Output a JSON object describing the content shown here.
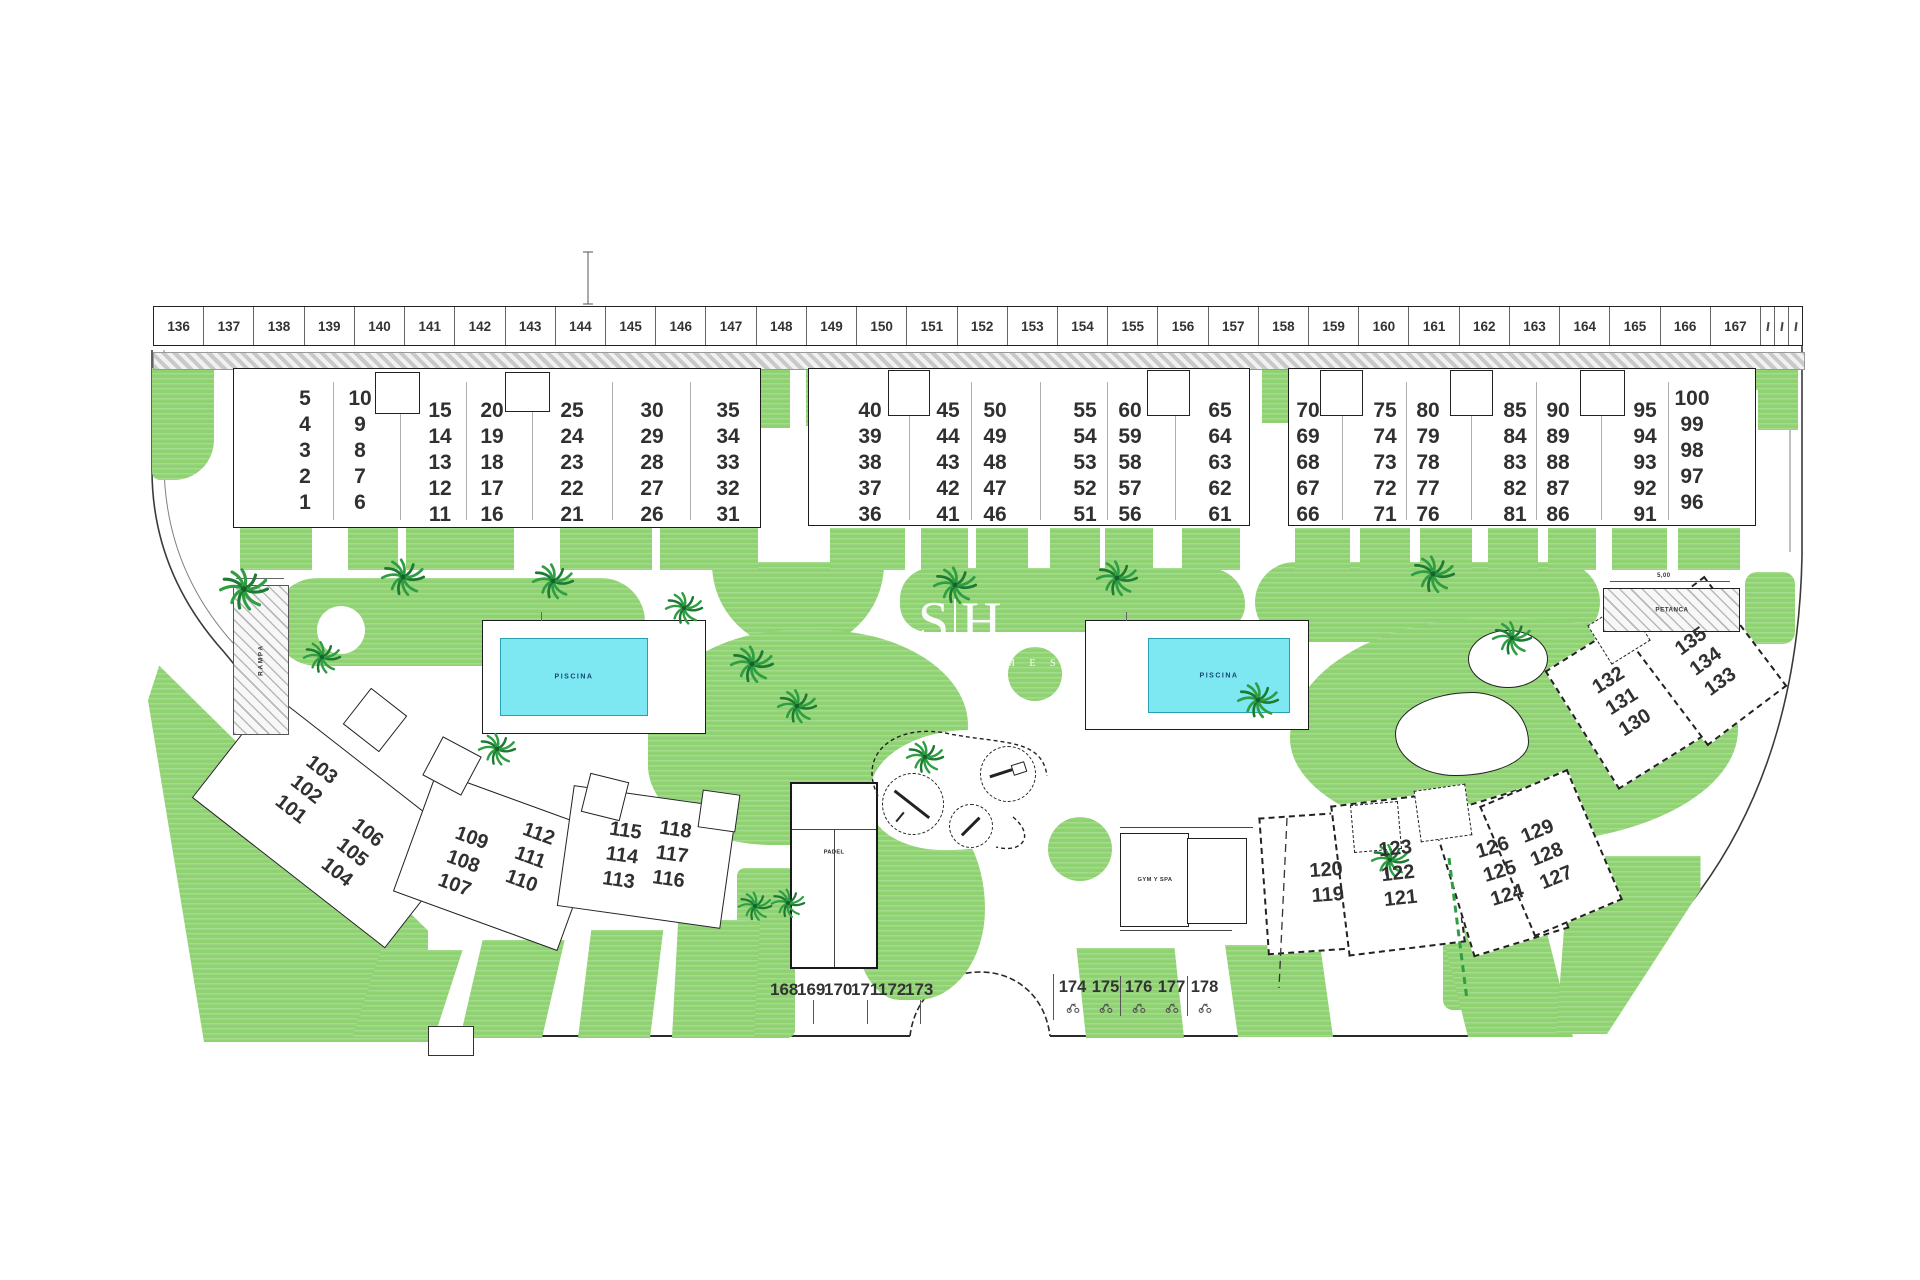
{
  "plan": {
    "watermark": {
      "left": "S",
      "right": "H",
      "sub": "M E S"
    },
    "parking": {
      "top_row": [
        "136",
        "137",
        "138",
        "139",
        "140",
        "141",
        "142",
        "143",
        "144",
        "145",
        "146",
        "147",
        "148",
        "149",
        "150",
        "151",
        "152",
        "153",
        "154",
        "155",
        "156",
        "157",
        "158",
        "159",
        "160",
        "161",
        "162",
        "163",
        "164",
        "165",
        "166",
        "167"
      ],
      "bottom_left_row": [
        "168",
        "169",
        "170",
        "171",
        "172",
        "173"
      ],
      "bottom_right_row": [
        "174",
        "175",
        "176",
        "177",
        "178"
      ]
    },
    "amenities": {
      "pool1_label": "PISCINA",
      "pool2_label": "PISCINA",
      "padel_label": "PADEL",
      "gym_label": "GYM Y SPA",
      "petanca_label": "PETANCA",
      "petanca_dim": "5,00",
      "ramp_label": "RAMPA"
    },
    "buildings": {
      "top": [
        {
          "name": "block-1",
          "columns": [
            [
              "5",
              "4",
              "3",
              "2",
              "1"
            ],
            [
              "10",
              "9",
              "8",
              "7",
              "6"
            ],
            [
              "15",
              "14",
              "13",
              "12",
              "11"
            ],
            [
              "20",
              "19",
              "18",
              "17",
              "16"
            ],
            [
              "25",
              "24",
              "23",
              "22",
              "21"
            ],
            [
              "30",
              "29",
              "28",
              "27",
              "26"
            ],
            [
              "35",
              "34",
              "33",
              "32",
              "31"
            ]
          ]
        },
        {
          "name": "block-2",
          "columns": [
            [
              "40",
              "39",
              "38",
              "37",
              "36"
            ],
            [
              "45",
              "44",
              "43",
              "42",
              "41"
            ],
            [
              "50",
              "49",
              "48",
              "47",
              "46"
            ],
            [
              "55",
              "54",
              "53",
              "52",
              "51"
            ],
            [
              "60",
              "59",
              "58",
              "57",
              "56"
            ],
            [
              "65",
              "64",
              "63",
              "62",
              "61"
            ]
          ]
        },
        {
          "name": "block-3",
          "columns": [
            [
              "70",
              "69",
              "68",
              "67",
              "66"
            ],
            [
              "75",
              "74",
              "73",
              "72",
              "71"
            ],
            [
              "80",
              "79",
              "78",
              "77",
              "76"
            ],
            [
              "85",
              "84",
              "83",
              "82",
              "81"
            ],
            [
              "90",
              "89",
              "88",
              "87",
              "86"
            ],
            [
              "95",
              "94",
              "93",
              "92",
              "91"
            ],
            [
              "100",
              "99",
              "98",
              "97",
              "96"
            ]
          ]
        }
      ],
      "bottom": [
        {
          "lines": [
            "103",
            "102",
            "101"
          ]
        },
        {
          "lines": [
            "106",
            "105",
            "104"
          ]
        },
        {
          "lines": [
            "109",
            "108",
            "107"
          ]
        },
        {
          "lines": [
            "112",
            "111",
            "110"
          ]
        },
        {
          "lines": [
            "115",
            "114",
            "113"
          ]
        },
        {
          "lines": [
            "118",
            "117",
            "116"
          ]
        },
        {
          "lines": [
            "120",
            "119"
          ]
        },
        {
          "lines": [
            "123",
            "122",
            "121"
          ]
        },
        {
          "lines": [
            "126",
            "125",
            "124"
          ]
        },
        {
          "lines": [
            "129",
            "128",
            "127"
          ]
        },
        {
          "lines": [
            "132",
            "131",
            "130"
          ]
        },
        {
          "lines": [
            "135",
            "134",
            "133"
          ]
        }
      ]
    },
    "icons": {
      "tree": "palm-tree-icon",
      "parking_glyph": "scooter-icon",
      "seesaw": "seesaw-icon",
      "slide": "slide-icon"
    },
    "colors": {
      "lawn": "#8ed271",
      "lawn_dark": "#2f9e43",
      "water": "#7de8f2",
      "water_edge": "#2aa0b5",
      "outline": "#1c1c1c",
      "number": "#303030",
      "hatch_line": "#b9b9b9"
    }
  }
}
